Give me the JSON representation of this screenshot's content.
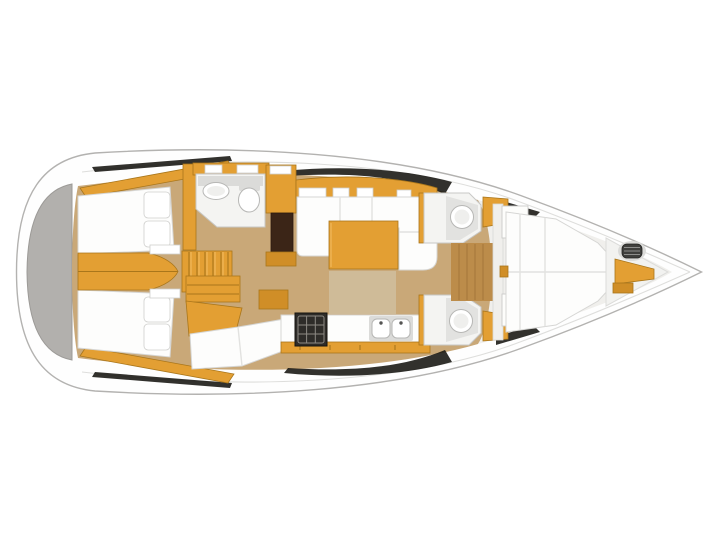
{
  "image": {
    "kind": "sailboat-interior-floor-plan",
    "view": "top-down",
    "orientation": "bow-right",
    "background": "#ffffff"
  },
  "colors": {
    "hull_fill": "#fefefe",
    "hull_stroke": "#b3b2b0",
    "deck_line": "#dededc",
    "transom_gray": "#b2b0ad",
    "transom_edge": "#9c9a97",
    "wood": "#e39f33",
    "wood_light": "#f3be63",
    "wood_shadow": "#a9761b",
    "wood_dark": "#d08e27",
    "floor_tan": "#c9a878",
    "floor_wood": "#bc8c4a",
    "rug": "#cfbb98",
    "fwd_floor": "#f0efec",
    "white_furn": "#fdfdfc",
    "furn_stroke": "#d6d6d4",
    "head_white": "#f4f4f2",
    "fixture_gray": "#dbdbd9",
    "fixture_stroke": "#b7b7b5",
    "dark_brown": "#3b2517",
    "stove_dark": "#2e2c29",
    "stove_grid": "#8d8a84",
    "shadow_black": "#161410",
    "metal": "#3f3f3d",
    "metal_light": "#8e8e8c",
    "shower_gray": "#e2e2e0"
  },
  "areas": [
    {
      "id": "stern-platform"
    },
    {
      "id": "aft-cabin-port"
    },
    {
      "id": "aft-cabin-starboard"
    },
    {
      "id": "companionway-stairs"
    },
    {
      "id": "aft-head"
    },
    {
      "id": "nav-station"
    },
    {
      "id": "saloon-settee"
    },
    {
      "id": "saloon-table"
    },
    {
      "id": "galley"
    },
    {
      "id": "galley-stove"
    },
    {
      "id": "galley-sink"
    },
    {
      "id": "forward-head-port"
    },
    {
      "id": "forward-head-starboard"
    },
    {
      "id": "forward-cabin-berth"
    },
    {
      "id": "bow-locker"
    },
    {
      "id": "windlass"
    }
  ]
}
